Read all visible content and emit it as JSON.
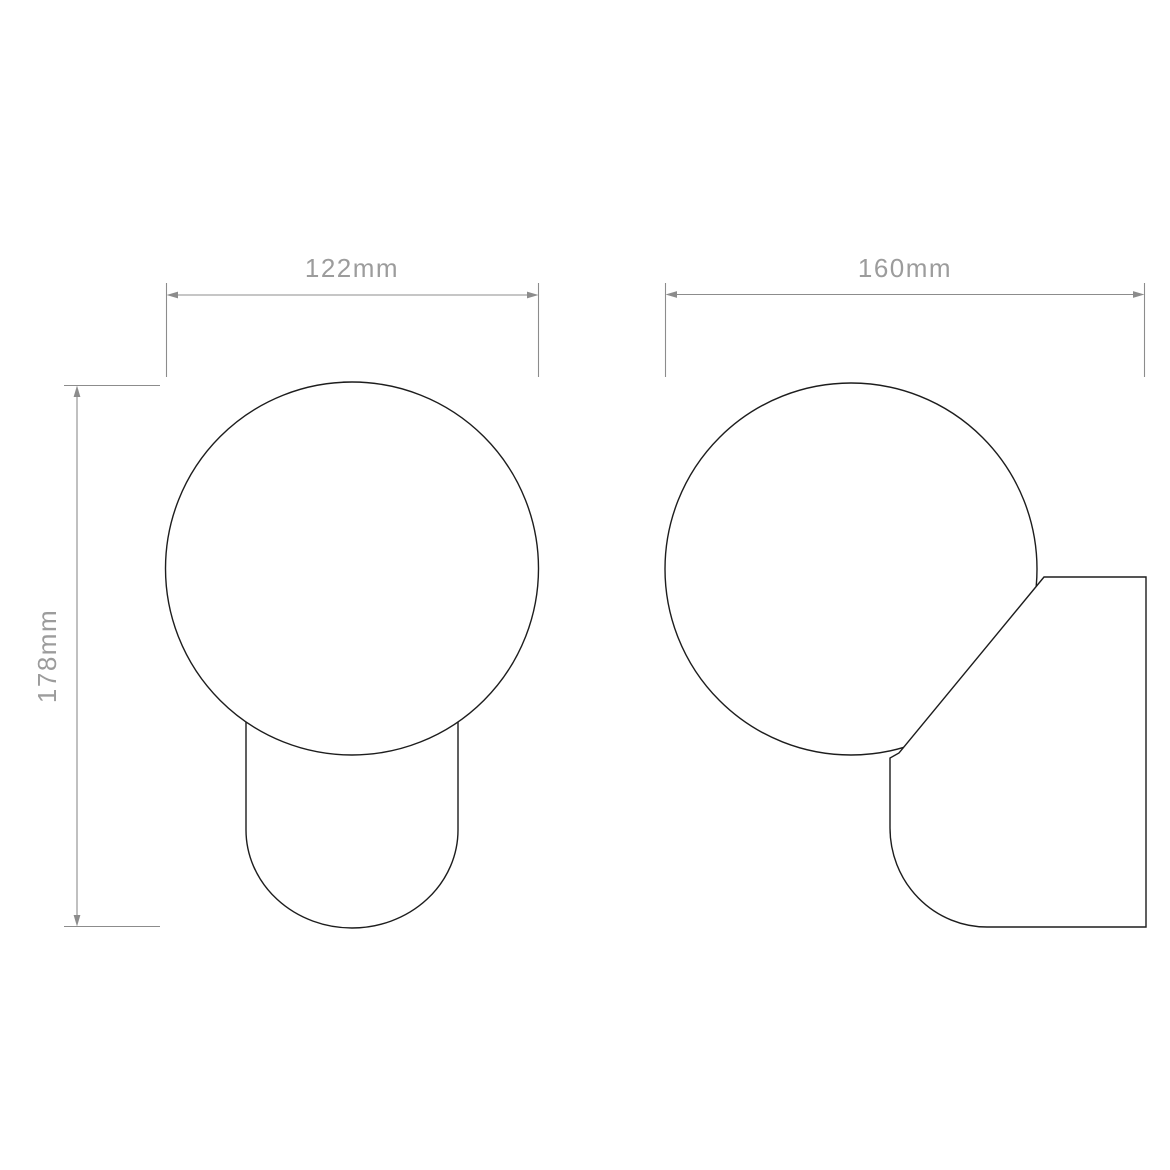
{
  "drawing": {
    "outline_color": "#1d1d1d",
    "dimension_color": "#8c8c8c",
    "label_color": "#9c9c9c",
    "background_color": "#ffffff",
    "labels": {
      "front_width": "122mm",
      "front_height": "178mm",
      "side_width": "160mm"
    }
  }
}
